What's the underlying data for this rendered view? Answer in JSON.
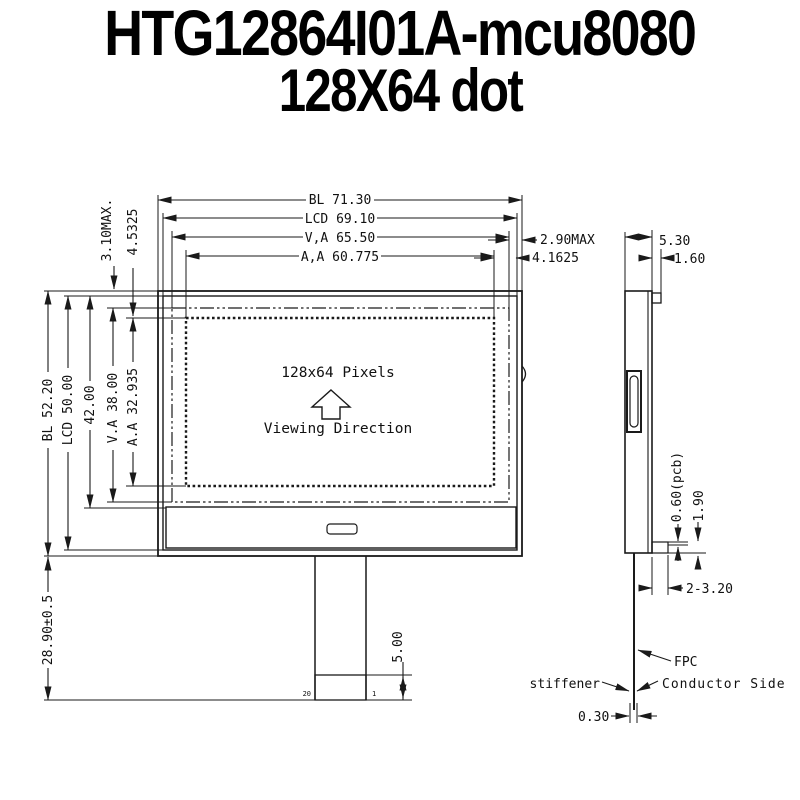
{
  "title": {
    "line1": "HTG12864I01A-mcu8080",
    "line2": "128X64 dot"
  },
  "front_view": {
    "display": {
      "pixels": "128x64 Pixels",
      "viewing_direction": "Viewing Direction"
    },
    "pins": {
      "last": "20",
      "first": "1"
    },
    "dims": {
      "width_bl": "BL 71.30",
      "width_lcd": "LCD 69.10",
      "width_va": "V,A 65.50",
      "width_aa": "A,A 60.775",
      "gap_right_va": "2.90MAX",
      "gap_right_aa": "4.1625",
      "gap_top_va": "3.10MAX.",
      "gap_top_aa": "4.5325",
      "height_bl": "BL 52.20",
      "height_lcd": "LCD 50.00",
      "height_mid": "42.00",
      "height_va": "V.A 38.00",
      "height_aa": "A.A 32.935",
      "tail_length": "28.90±0.5",
      "contact_length": "5.00"
    }
  },
  "side_view": {
    "dims": {
      "thickness": "5.30",
      "bezel_tab": "1.60",
      "pcb_thickness": "0.60(pcb)",
      "pcb_gap": "1.90",
      "hole": "2-3.20",
      "fpc_thickness": "0.30"
    },
    "labels": {
      "stiffener": "stiffener",
      "fpc": "FPC",
      "conductor_side": "Conductor Side"
    }
  },
  "colors": {
    "line": "#1a1a1a",
    "background": "#ffffff",
    "title": "#000000"
  }
}
